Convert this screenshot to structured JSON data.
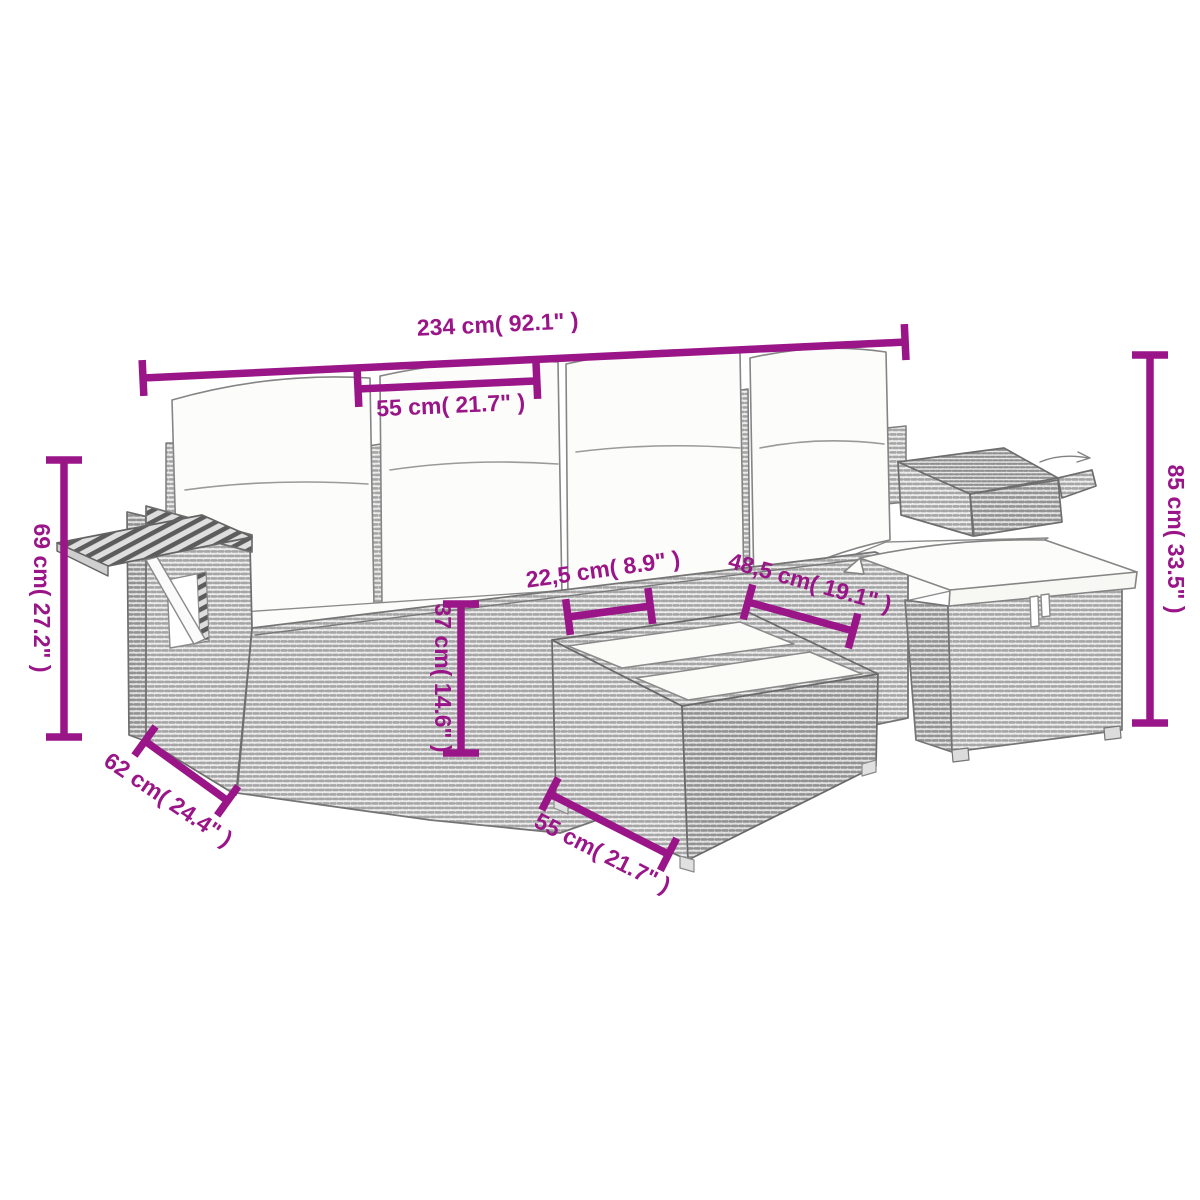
{
  "diagram": {
    "subject": "garden lounge furniture set line drawing with measurements",
    "accent_color": "#9A1588",
    "dimensions": {
      "overall_width": "234 cm( 92.1\" )",
      "backrest_cushion_width": "55 cm( 21.7\" )",
      "armrest_height": "69 cm( 27.2\" )",
      "total_height": "85 cm( 33.5\" )",
      "seat_front_height": "37 cm( 14.6\" )",
      "gap_width": "22,5 cm( 8.9\" )",
      "footrest_width": "48,5 cm( 19.1\" )",
      "seat_depth": "62 cm( 24.4\" )",
      "table_width": "55 cm( 21.7\" )"
    }
  }
}
